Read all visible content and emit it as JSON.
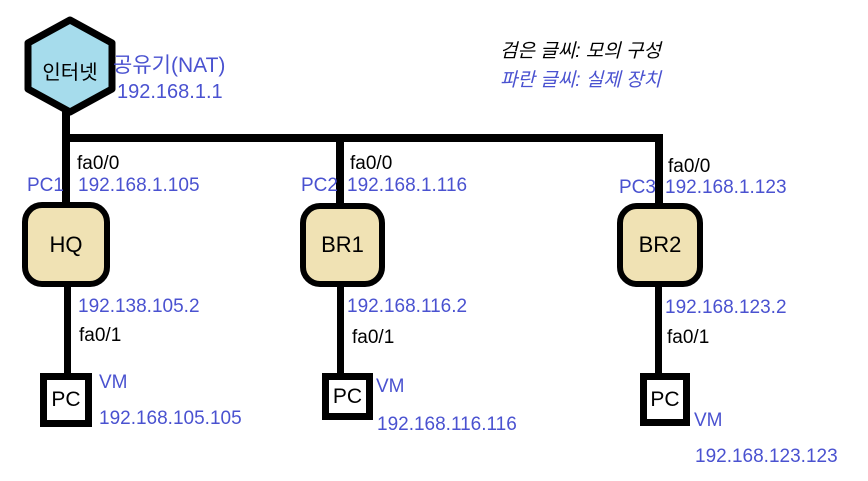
{
  "internet": {
    "label": "인터넷",
    "device": "공유기(NAT)",
    "ip": "192.168.1.1"
  },
  "legend": {
    "black_note": "검은 글씨: 모의 구성",
    "blue_note": "파란 글씨: 실제 장치"
  },
  "branches": [
    {
      "uplink_interface": "fa0/0",
      "host_pc": "PC1",
      "uplink_ip": "192.168.1.105",
      "router": "HQ",
      "lan_ip": "192.138.105.2",
      "lan_interface": "fa0/1",
      "pc_label": "PC",
      "vm_label": "VM",
      "vm_ip": "192.168.105.105"
    },
    {
      "uplink_interface": "fa0/0",
      "host_pc": "PC2",
      "uplink_ip": "192.168.1.116",
      "router": "BR1",
      "lan_ip": "192.168.116.2",
      "lan_interface": "fa0/1",
      "pc_label": "PC",
      "vm_label": "VM",
      "vm_ip": "192.168.116.116"
    },
    {
      "uplink_interface": "fa0/0",
      "host_pc": "PC3",
      "uplink_ip": "192.168.1.123",
      "router": "BR2",
      "lan_ip": "192.168.123.2",
      "lan_interface": "fa0/1",
      "pc_label": "PC",
      "vm_label": "VM",
      "vm_ip": "192.168.123.123"
    }
  ],
  "colors": {
    "internet_fill": "#a6dcec",
    "router_fill": "#f0e2b4",
    "blue_text": "#4a52d0",
    "line": "#000000"
  }
}
